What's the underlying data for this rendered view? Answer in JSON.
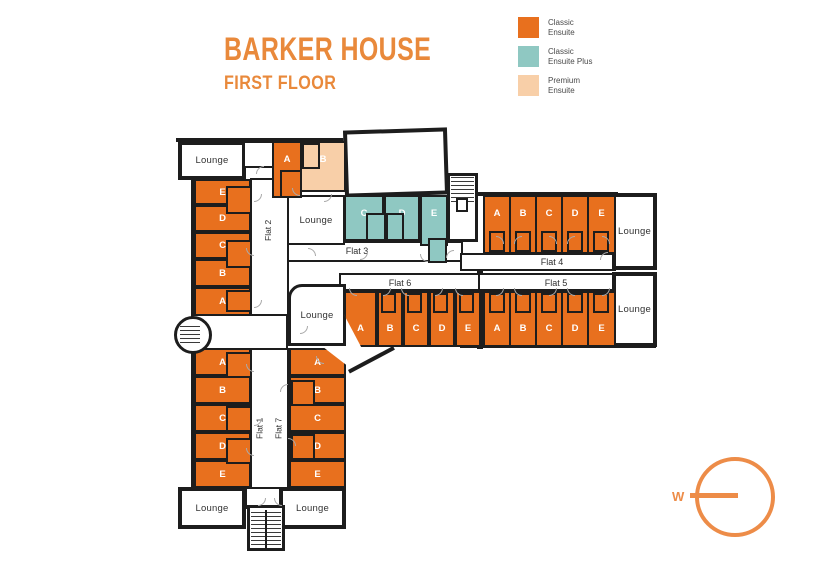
{
  "header": {
    "title": "BARKER HOUSE",
    "subtitle": "FIRST FLOOR",
    "accent_color": "#e9893b"
  },
  "legend": {
    "items": [
      {
        "label_line1": "Classic",
        "label_line2": "Ensuite",
        "color": "#e8701e"
      },
      {
        "label_line1": "Classic",
        "label_line2": "Ensuite Plus",
        "color": "#8fc8c2"
      },
      {
        "label_line1": "Premium",
        "label_line2": "Ensuite",
        "color": "#f8cfa8"
      }
    ]
  },
  "plan": {
    "lounge_label": "Lounge",
    "wall_color": "#1d1d1d",
    "flats": {
      "flat1": {
        "label": "Flat 1",
        "rooms": [
          "A",
          "B",
          "C",
          "D",
          "E"
        ]
      },
      "flat2": {
        "label": "Flat 2",
        "rooms": [
          "E",
          "D",
          "C",
          "B",
          "A"
        ]
      },
      "flat3": {
        "label": "Flat 3",
        "rooms_top": [
          "A",
          "B"
        ],
        "rooms": [
          "C",
          "D",
          "E"
        ]
      },
      "flat4": {
        "label": "Flat 4",
        "rooms": [
          "A",
          "B",
          "C",
          "D",
          "E"
        ]
      },
      "flat5": {
        "label": "Flat 5",
        "rooms": [
          "A",
          "B",
          "C",
          "D",
          "E"
        ]
      },
      "flat6": {
        "label": "Flat 6",
        "rooms": [
          "A",
          "B",
          "C",
          "D",
          "E"
        ]
      },
      "flat7": {
        "label": "Flat 7",
        "rooms": [
          "A",
          "B",
          "C",
          "D",
          "E"
        ]
      }
    }
  },
  "compass": {
    "west": "W",
    "color": "#ed8c48"
  }
}
